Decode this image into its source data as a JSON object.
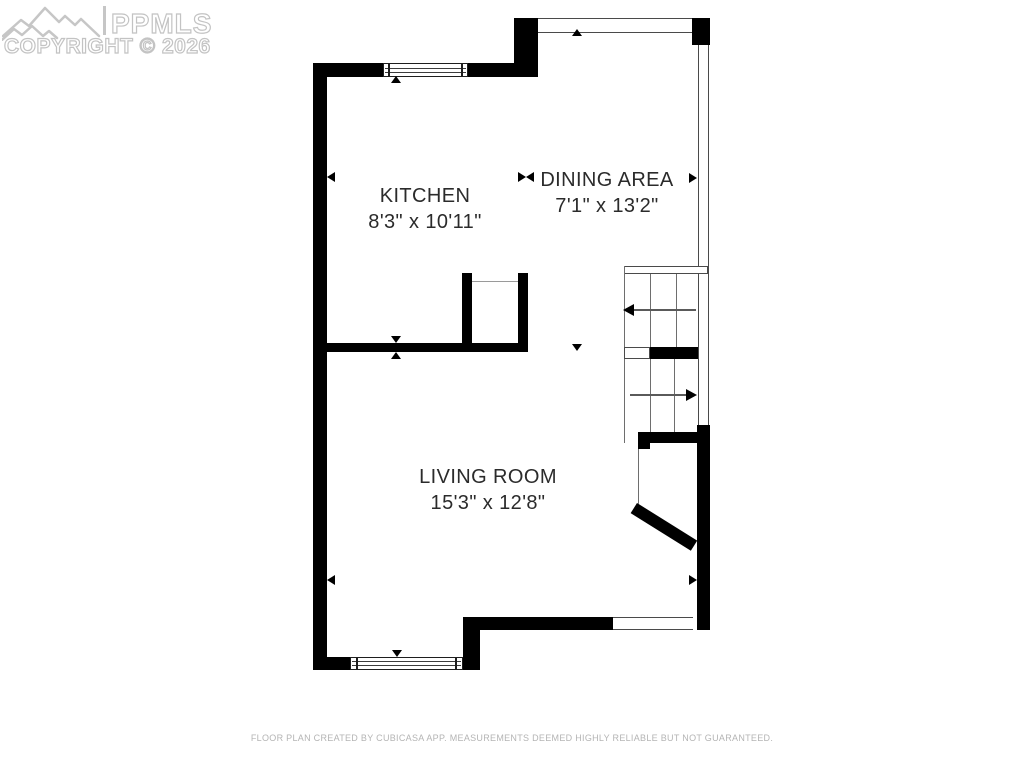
{
  "watermark": {
    "brand": "PPMLS",
    "copyright_line": "COPYRIGHT © 2026",
    "logo": "mountain-range-icon"
  },
  "rooms": [
    {
      "name": "KITCHEN",
      "dimensions": "8'3\" x 10'11\""
    },
    {
      "name": "DINING AREA",
      "dimensions": "7'1\" x 13'2\""
    },
    {
      "name": "LIVING ROOM",
      "dimensions": "15'3\" x 12'8\""
    }
  ],
  "footer": {
    "disclaimer": "FLOOR PLAN CREATED BY CUBICASA APP. MEASUREMENTS DEEMED HIGHLY RELIABLE BUT NOT GUARANTEED."
  },
  "colors": {
    "wall": "#000000",
    "thin_line": "#4a4a4a",
    "stair_line": "#6e6e6e",
    "label_text": "#2b2b2b",
    "watermark": "#c3c3c3",
    "footer_text": "#b4b4b4",
    "background": "#ffffff"
  }
}
